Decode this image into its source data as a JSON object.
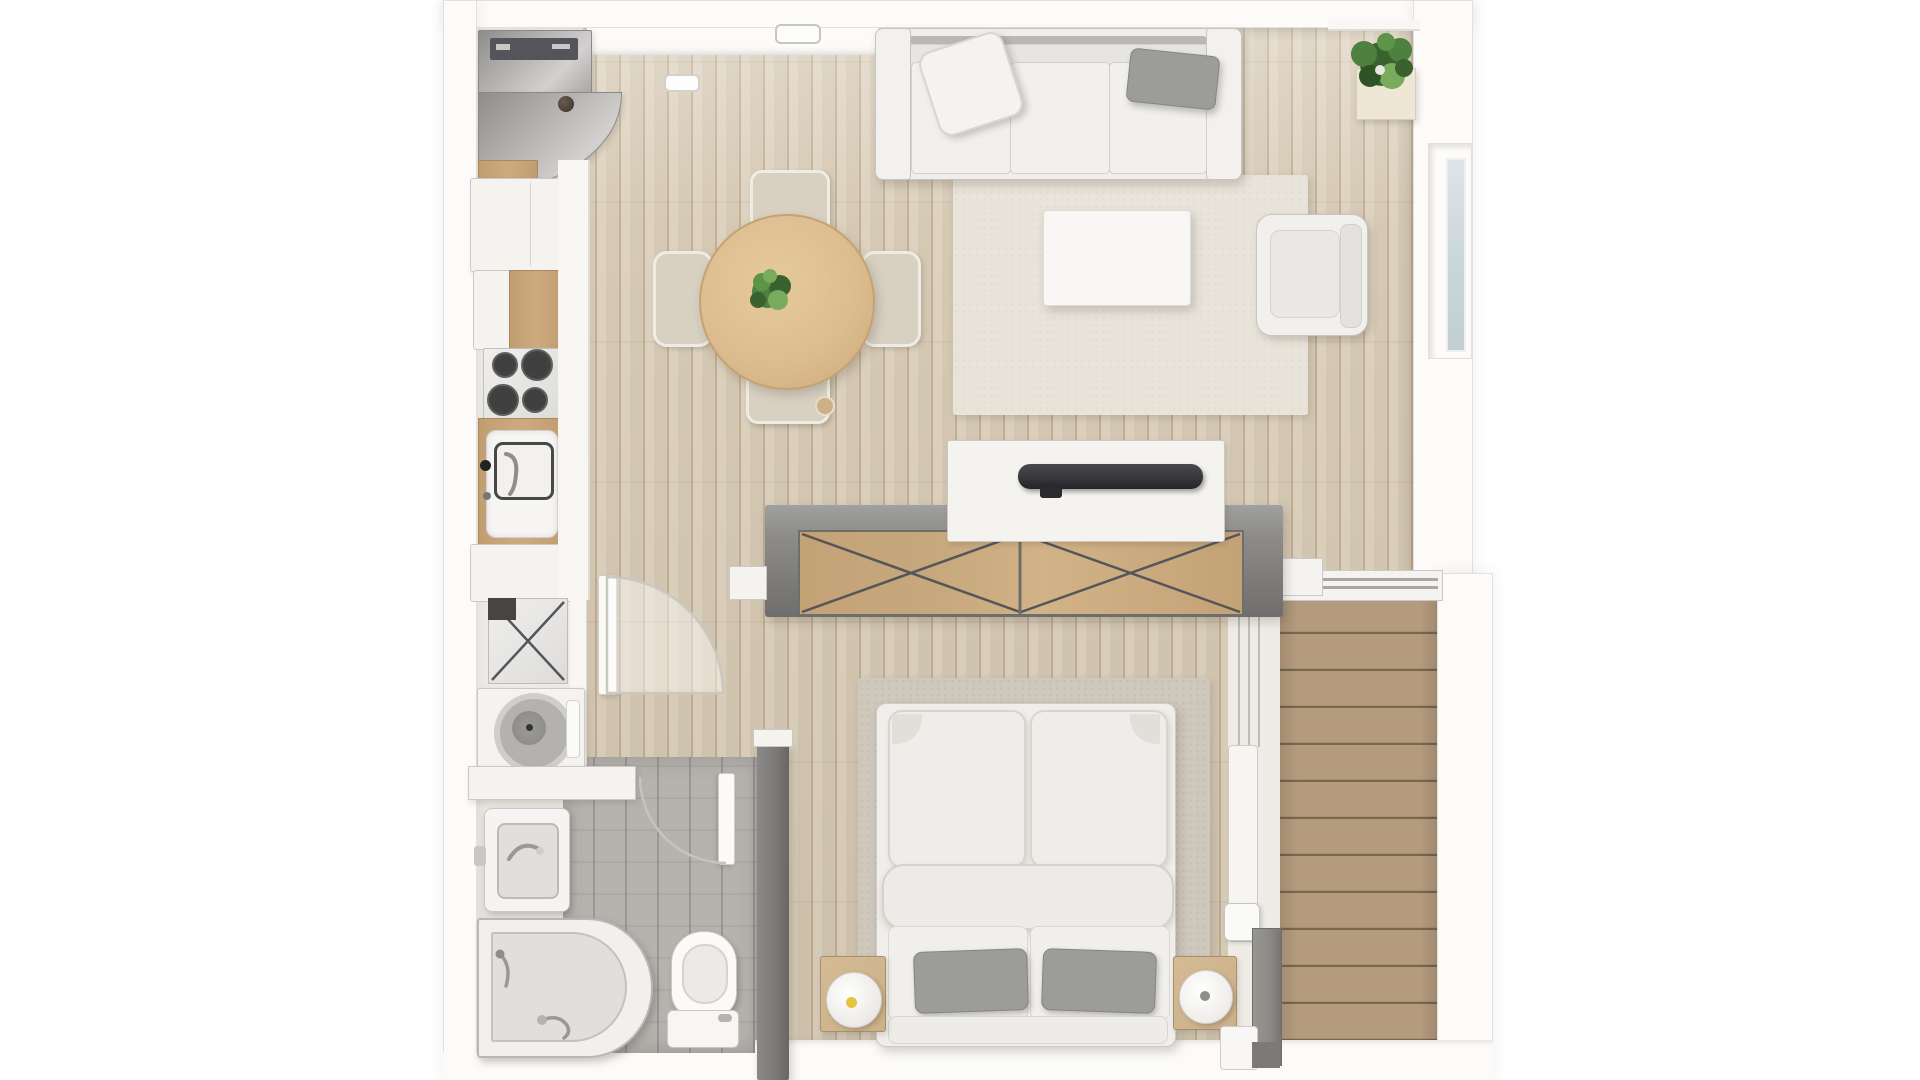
{
  "scene": {
    "title": "Studio apartment floor plan - top-down 3D render",
    "view": "top-down",
    "canvas": {
      "width": 1920,
      "height": 1080
    },
    "has_text": false
  },
  "palette": {
    "white": "#ffffff",
    "wall": "#fcfbfa",
    "wall_line": "#e4e1dc",
    "floor_wood": "#d6c9b4",
    "floor_wood_dark": "#c2b096",
    "floor_wood_light": "#ddd2bf",
    "deck": "#b59b7d",
    "deck_line": "#77674f",
    "deck_edge": "#f0e8d8",
    "tile": "#b6b3ae",
    "divider": "#8c8b89",
    "divider_dark": "#6f6e6c",
    "dark_wall": "#7a7977",
    "wood_doors": "#c7a87d",
    "wood_door_line": "#55555a",
    "white_furn": "#f4f3f0",
    "furn_line": "#ccc9c4",
    "sofa": "#efeeeb",
    "sofa_line": "#c6c4c0",
    "sofa_shade": "#97958f",
    "pillow_gray": "#9c9c9a",
    "rug_living": "#e9e4da",
    "rug_bed": "#cfc8bc",
    "table_wood": "#ddbd90",
    "counter_wood": "#cdab7e",
    "metal_light": "#d2d1cf",
    "metal_dark": "#8e8d8b",
    "plant_dark": "#39622e",
    "plant_mid": "#4e8040",
    "plant_light": "#79ab5d",
    "lamp_yellow": "#e6c33c",
    "glass": "#ccd7dc",
    "tv": "#35353a",
    "burner": "#454545",
    "bed_white": "#f0eeea",
    "nightstand": "#cbb089",
    "chair": "#d8d1c2",
    "chair_line": "#b6ae9d",
    "tub_inner": "#e0dfdc"
  },
  "rooms": [
    {
      "name": "kitchen",
      "furniture": [
        "curved-entry-cabinet",
        "tall-cabinet",
        "base-cabinet",
        "cooktop-4-burners",
        "kitchen-sink",
        "counter-end"
      ]
    },
    {
      "name": "laundry-nook",
      "furniture": [
        "laundry-hamper",
        "washing-machine",
        "wall-shelf"
      ]
    },
    {
      "name": "bathroom",
      "furniture": [
        "bathroom-sink",
        "corner-bathtub",
        "toilet",
        "bathroom-door"
      ]
    },
    {
      "name": "dining-area",
      "furniture": [
        "round-dining-table",
        "dining-chair-top",
        "dining-chair-left",
        "dining-chair-right",
        "dining-chair-bottom",
        "table-plant"
      ]
    },
    {
      "name": "living-room",
      "furniture": [
        "three-seat-sofa",
        "white-throw-pillow",
        "gray-throw-pillow",
        "coffee-table",
        "armchair",
        "living-rug",
        "corner-potted-plant",
        "tv-sideboard",
        "tv-soundbar",
        "ceiling-light"
      ]
    },
    {
      "name": "bedroom",
      "furniture": [
        "double-bed",
        "gray-bed-pillow-left",
        "gray-bed-pillow-right",
        "nightstand-left-with-lamp",
        "nightstand-right-with-speaker",
        "bedroom-rug",
        "sliding-door-wardrobe"
      ]
    },
    {
      "name": "balcony",
      "furniture": [
        "wood-decking",
        "sliding-glass-door",
        "railing-ledge"
      ]
    },
    {
      "name": "hallway",
      "furniture": [
        "hall-door",
        "door-swing-arc"
      ]
    }
  ],
  "windows": [
    {
      "name": "right-wall-window",
      "glazing": "frosted"
    }
  ],
  "lights": [
    {
      "name": "ceiling-light-living"
    },
    {
      "name": "ceiling-light-entry"
    }
  ]
}
